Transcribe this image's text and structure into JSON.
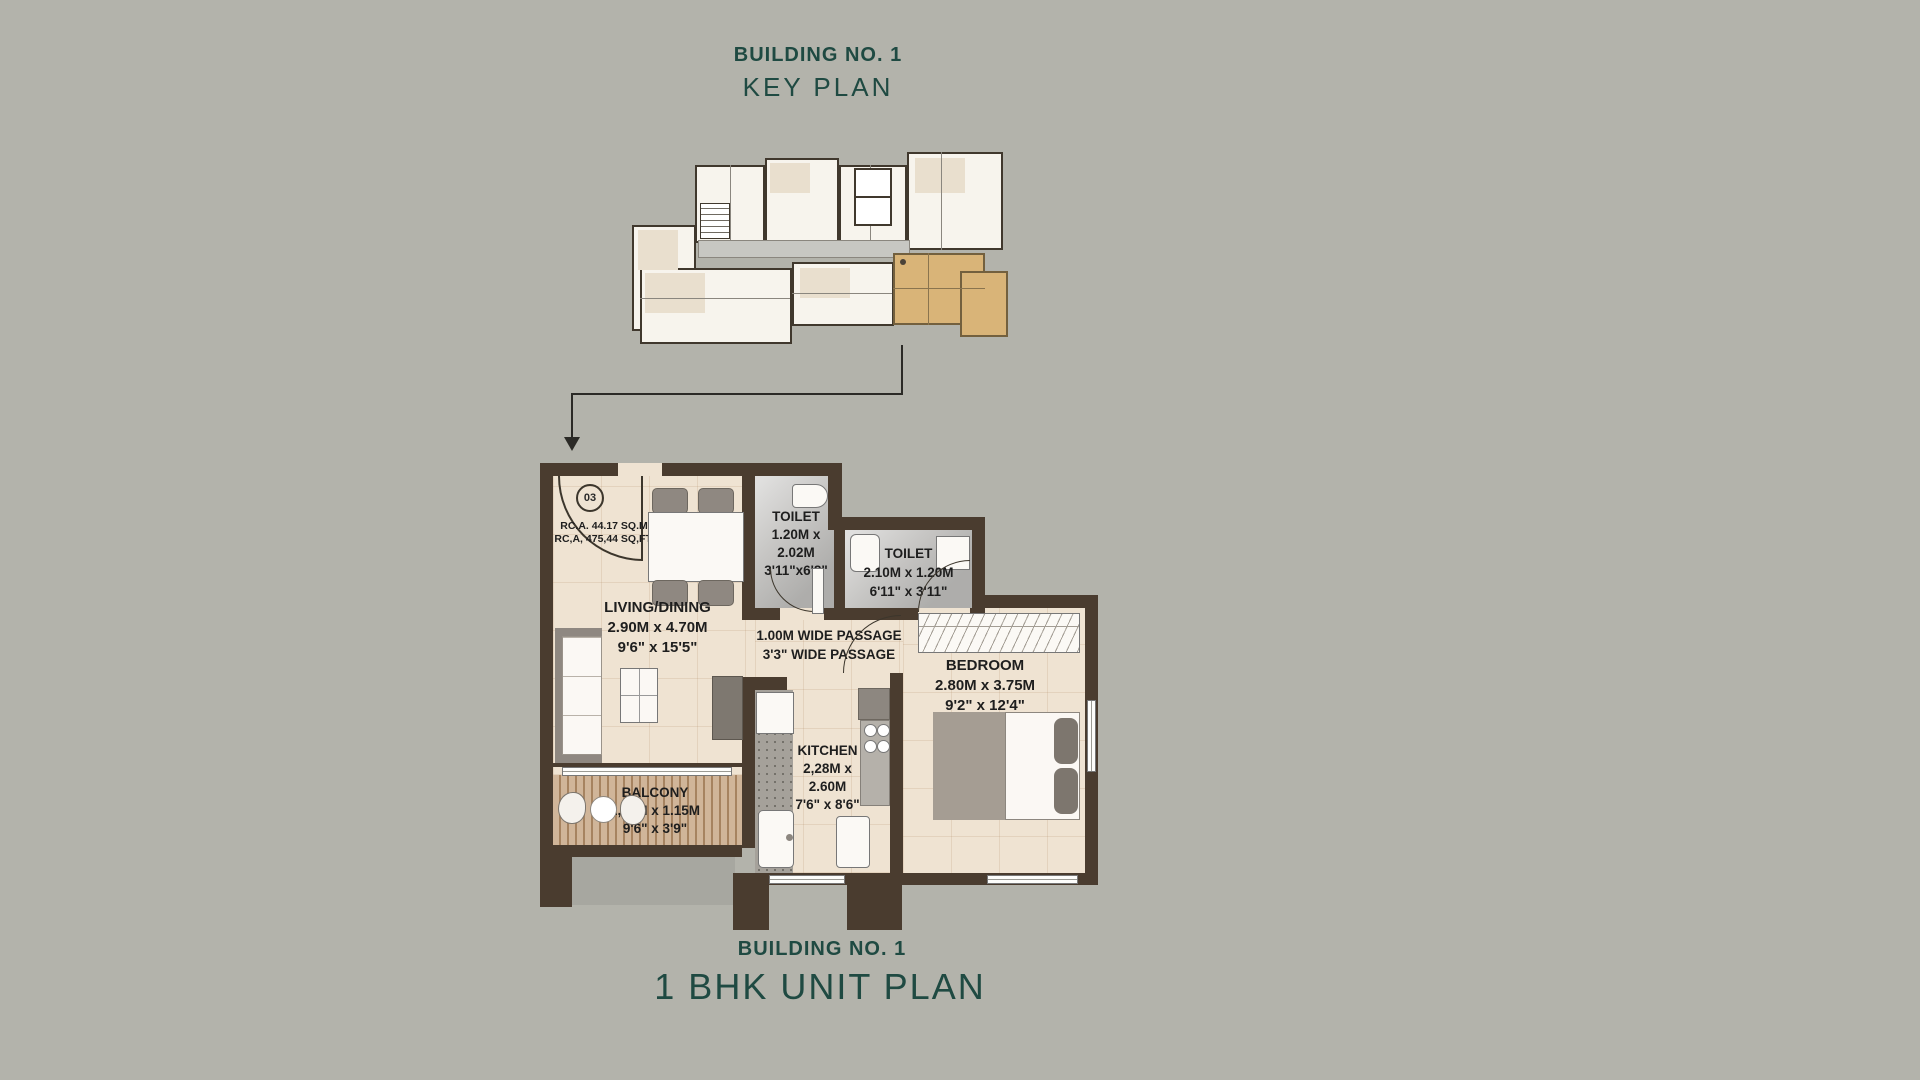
{
  "colors": {
    "bg": "#b3b3ab",
    "teal": "#1f4a42",
    "wall": "#4a3c2f",
    "orange": "#d9b478",
    "floor": "#efe3d2",
    "marble": "#c6c5c3",
    "wood": "#c3a07c",
    "ink": "#1e1e1e"
  },
  "titles": {
    "key": {
      "line1": "BUILDING NO. 1",
      "line2": "KEY PLAN"
    },
    "unit": {
      "line1": "BUILDING NO. 1",
      "line2": "1 BHK UNIT PLAN"
    }
  },
  "unit_plan": {
    "unit_number": "03",
    "area": {
      "line1": "RC.A. 44.17 SQ.M",
      "line2": "RC,A, 475,44 SQ,FT,"
    },
    "rooms": {
      "living": {
        "name": "LIVING/DINING",
        "metric": "2.90M x 4.70M",
        "imperial": "9'6\" x 15'5\""
      },
      "toilet1": {
        "name": "TOILET",
        "metric1": "1.20M x",
        "metric2": "2.02M",
        "imperial": "3'11\"x6'8\""
      },
      "toilet2": {
        "name": "TOILET",
        "metric": "2.10M x 1.20M",
        "imperial": "6'11\" x 3'11\""
      },
      "passage": {
        "line1": "1.00M WIDE PASSAGE",
        "line2": "3'3\" WIDE PASSAGE"
      },
      "bedroom": {
        "name": "BEDROOM",
        "metric": "2.80M x 3.75M",
        "imperial": "9'2\" x 12'4\""
      },
      "kitchen": {
        "name": "KITCHEN",
        "metric1": "2,28M x",
        "metric2": "2.60M",
        "imperial": "7'6\" x 8'6\""
      },
      "balcony": {
        "name": "BALCONY",
        "metric": "2,90M x 1.15M",
        "imperial": "9'6\" x 3'9\""
      }
    }
  }
}
